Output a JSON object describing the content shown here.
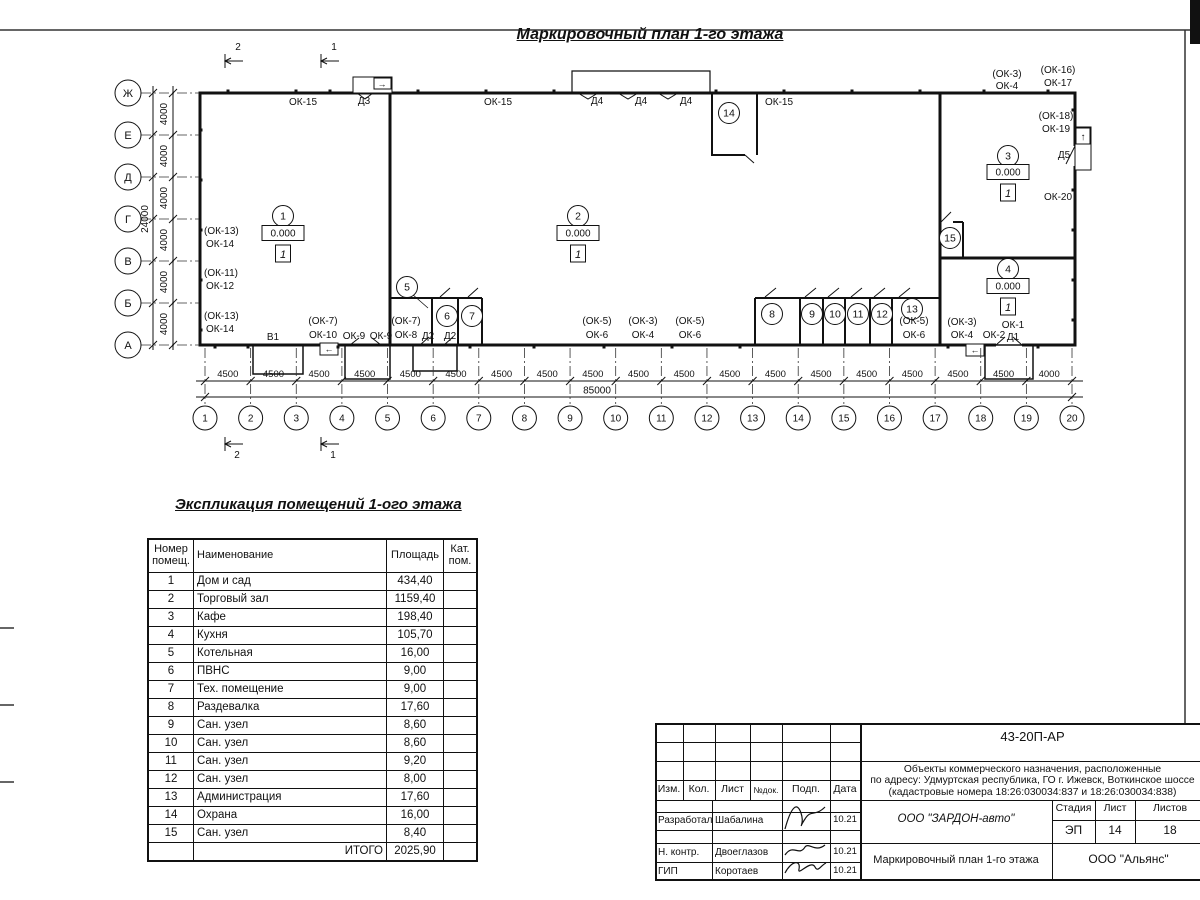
{
  "title": "Маркировочный план 1-го этажа",
  "plan": {
    "row_axes": [
      "Ж",
      "Е",
      "Д",
      "Г",
      "В",
      "Б",
      "А"
    ],
    "row_dim_text": "4000",
    "row_total": "24000",
    "col_labels": [
      "1",
      "2",
      "3",
      "4",
      "5",
      "6",
      "7",
      "8",
      "9",
      "10",
      "11",
      "12",
      "13",
      "14",
      "15",
      "16",
      "17",
      "18",
      "19",
      "20"
    ],
    "col_dims": [
      "4500",
      "4500",
      "4500",
      "4500",
      "4500",
      "4500",
      "4500",
      "4500",
      "4500",
      "4500",
      "4500",
      "4500",
      "4500",
      "4500",
      "4500",
      "4500",
      "4500",
      "4500",
      "4000"
    ],
    "col_total": "85000",
    "elev_text": "0.000",
    "floor_text": "1",
    "room_bubbles": [
      {
        "n": "1",
        "x": 283,
        "y": 216
      },
      {
        "n": "2",
        "x": 578,
        "y": 216
      },
      {
        "n": "3",
        "x": 1008,
        "y": 156
      },
      {
        "n": "4",
        "x": 1008,
        "y": 269
      },
      {
        "n": "5",
        "x": 407,
        "y": 287
      },
      {
        "n": "6",
        "x": 447,
        "y": 316
      },
      {
        "n": "7",
        "x": 472,
        "y": 316
      },
      {
        "n": "8",
        "x": 772,
        "y": 314
      },
      {
        "n": "9",
        "x": 812,
        "y": 314
      },
      {
        "n": "10",
        "x": 835,
        "y": 314
      },
      {
        "n": "11",
        "x": 858,
        "y": 314
      },
      {
        "n": "12",
        "x": 882,
        "y": 314
      },
      {
        "n": "13",
        "x": 912,
        "y": 309
      },
      {
        "n": "14",
        "x": 729,
        "y": 113
      },
      {
        "n": "15",
        "x": 950,
        "y": 238
      }
    ],
    "elev_markers": [
      {
        "x": 283,
        "y": 233
      },
      {
        "x": 578,
        "y": 233
      },
      {
        "x": 1008,
        "y": 172
      },
      {
        "x": 1008,
        "y": 286
      }
    ],
    "labels": [
      {
        "t": "ОК-15",
        "x": 303,
        "y": 105
      },
      {
        "t": "Д3",
        "x": 364,
        "y": 104
      },
      {
        "t": "ОК-15",
        "x": 498,
        "y": 105
      },
      {
        "t": "Д4",
        "x": 597,
        "y": 104
      },
      {
        "t": "Д4",
        "x": 641,
        "y": 104
      },
      {
        "t": "Д4",
        "x": 686,
        "y": 104
      },
      {
        "t": "ОК-15",
        "x": 779,
        "y": 105
      },
      {
        "t": "(ОК-3)",
        "x": 1007,
        "y": 77
      },
      {
        "t": "ОК-4",
        "x": 1007,
        "y": 89
      },
      {
        "t": "(ОК-16)",
        "x": 1058,
        "y": 73
      },
      {
        "t": "ОК-17",
        "x": 1058,
        "y": 86
      },
      {
        "t": "(ОК-18)",
        "x": 1056,
        "y": 119
      },
      {
        "t": "ОК-19",
        "x": 1056,
        "y": 132
      },
      {
        "t": "Д5",
        "x": 1064,
        "y": 158
      },
      {
        "t": "ОК-20",
        "x": 1058,
        "y": 200
      },
      {
        "t": "(ОК-13)",
        "x": 204,
        "y": 234,
        "a": "start"
      },
      {
        "t": "ОК-14",
        "x": 206,
        "y": 247,
        "a": "start"
      },
      {
        "t": "(ОК-11)",
        "x": 204,
        "y": 276,
        "a": "start"
      },
      {
        "t": "ОК-12",
        "x": 206,
        "y": 289,
        "a": "start"
      },
      {
        "t": "(ОК-13)",
        "x": 204,
        "y": 319,
        "a": "start"
      },
      {
        "t": "ОК-14",
        "x": 206,
        "y": 332,
        "a": "start"
      },
      {
        "t": "В1",
        "x": 273,
        "y": 340
      },
      {
        "t": "(ОК-7)",
        "x": 323,
        "y": 324
      },
      {
        "t": "ОК-10",
        "x": 323,
        "y": 338
      },
      {
        "t": "ОК-9",
        "x": 354,
        "y": 339
      },
      {
        "t": "ОК-9",
        "x": 381,
        "y": 339
      },
      {
        "t": "(ОК-7)",
        "x": 406,
        "y": 324
      },
      {
        "t": "ОК-8",
        "x": 406,
        "y": 338
      },
      {
        "t": "Д2",
        "x": 428,
        "y": 339
      },
      {
        "t": "Д2",
        "x": 450,
        "y": 339
      },
      {
        "t": "(ОК-5)",
        "x": 597,
        "y": 324
      },
      {
        "t": "ОК-6",
        "x": 597,
        "y": 338
      },
      {
        "t": "(ОК-3)",
        "x": 643,
        "y": 324
      },
      {
        "t": "ОК-4",
        "x": 643,
        "y": 338
      },
      {
        "t": "(ОК-5)",
        "x": 690,
        "y": 324
      },
      {
        "t": "ОК-6",
        "x": 690,
        "y": 338
      },
      {
        "t": "(ОК-5)",
        "x": 914,
        "y": 324
      },
      {
        "t": "ОК-6",
        "x": 914,
        "y": 338
      },
      {
        "t": "(ОК-3)",
        "x": 962,
        "y": 325
      },
      {
        "t": "ОК-4",
        "x": 962,
        "y": 338
      },
      {
        "t": "ОК-2",
        "x": 994,
        "y": 338
      },
      {
        "t": "ОК-1",
        "x": 1013,
        "y": 328
      },
      {
        "t": "Д1",
        "x": 1013,
        "y": 340
      },
      {
        "t": "→",
        "x": 382,
        "y": 87,
        "fs": 9
      },
      {
        "t": "↑",
        "x": 1083,
        "y": 140,
        "fs": 10
      },
      {
        "t": "←",
        "x": 329,
        "y": 352,
        "fs": 9
      },
      {
        "t": "←",
        "x": 975,
        "y": 353,
        "fs": 9
      },
      {
        "t": "2",
        "x": 238,
        "y": 50
      },
      {
        "t": "1",
        "x": 334,
        "y": 50
      },
      {
        "t": "2",
        "x": 237,
        "y": 458
      },
      {
        "t": "1",
        "x": 333,
        "y": 458
      }
    ]
  },
  "explication": {
    "title": "Экспликация помещений 1-ого этажа",
    "headers": [
      "Номер помещ.",
      "Наименование",
      "Площадь",
      "Кат. пом."
    ],
    "rows": [
      [
        "1",
        "Дом и сад",
        "434,40"
      ],
      [
        "2",
        "Торговый зал",
        "1159,40"
      ],
      [
        "3",
        "Кафе",
        "198,40"
      ],
      [
        "4",
        "Кухня",
        "105,70"
      ],
      [
        "5",
        "Котельная",
        "16,00"
      ],
      [
        "6",
        "ПВНС",
        "9,00"
      ],
      [
        "7",
        "Тех. помещение",
        "9,00"
      ],
      [
        "8",
        "Раздевалка",
        "17,60"
      ],
      [
        "9",
        "Сан. узел",
        "8,60"
      ],
      [
        "10",
        "Сан. узел",
        "8,60"
      ],
      [
        "11",
        "Сан. узел",
        "9,20"
      ],
      [
        "12",
        "Сан. узел",
        "8,00"
      ],
      [
        "13",
        "Администрация",
        "17,60"
      ],
      [
        "14",
        "Охрана",
        "16,00"
      ],
      [
        "15",
        "Сан. узел",
        "8,40"
      ]
    ],
    "total_label": "ИТОГО",
    "total_value": "2025,90"
  },
  "titleblock": {
    "doc_number": "43-20П-АР",
    "desc_lines": [
      "Объекты коммерческого назначения, расположенные",
      "по адресу: Удмуртская республика, ГО г. Ижевск, Воткинское шоссе",
      "(кадастровые номера 18:26:030034:837 и 18:26:030034:838)"
    ],
    "header_cells": [
      "Изм.",
      "Кол.",
      "Лист",
      "№док.",
      "Подп.",
      "Дата"
    ],
    "stage_label": "Стадия",
    "sheet_label": "Лист",
    "sheets_label": "Листов",
    "stage": "ЭП",
    "sheet": "14",
    "sheets": "18",
    "company": "ООО \"ЗАРДОН-авто\"",
    "drawing_title": "Маркировочный план 1-го этажа",
    "contractor": "ООО \"Альянс\"",
    "sign_rows": [
      {
        "role": "Разработал",
        "name": "Шабалина",
        "date": "10.21"
      },
      {
        "role": "Н. контр.",
        "name": "Двоеглазов",
        "date": "10.21"
      },
      {
        "role": "ГИП",
        "name": "Коротаев",
        "date": "10.21"
      }
    ]
  }
}
